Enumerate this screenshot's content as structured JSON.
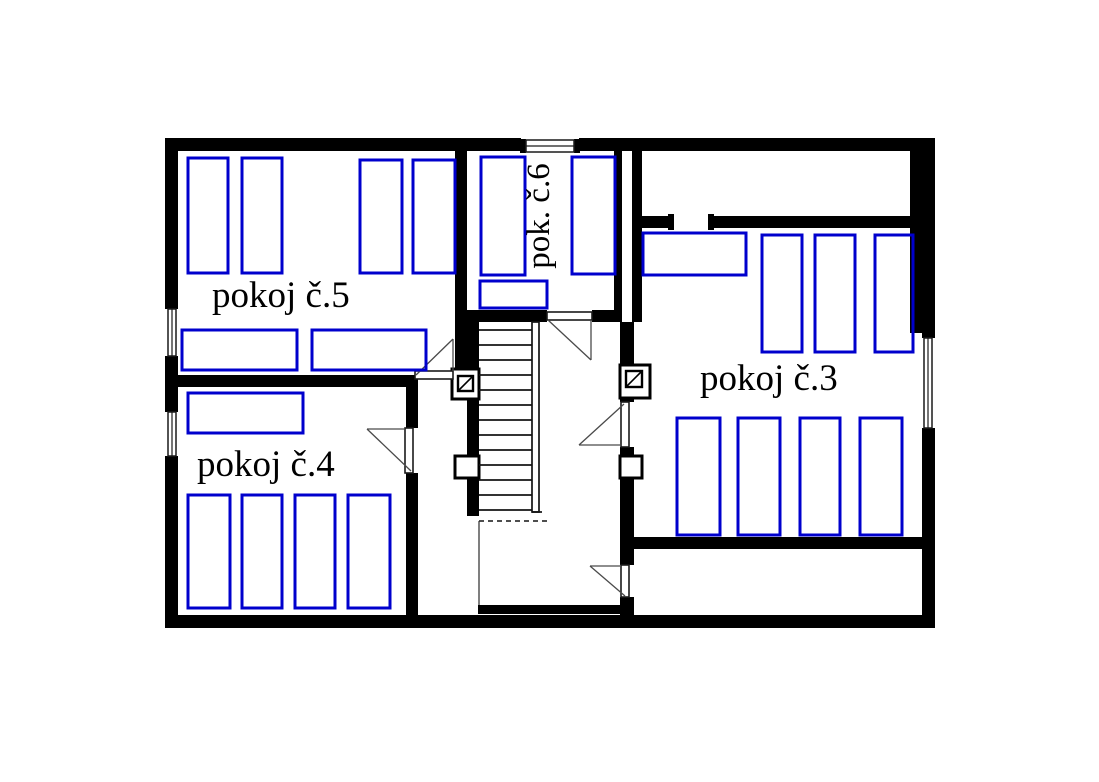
{
  "plan": {
    "type": "floor-plan",
    "rooms": [
      {
        "id": "room5",
        "label": "pokoj č.5",
        "furniture_count": 6
      },
      {
        "id": "room4",
        "label": "pokoj č.4",
        "furniture_count": 5
      },
      {
        "id": "room6",
        "label": "pok. č.6",
        "furniture_count": 3
      },
      {
        "id": "room3",
        "label": "pokoj č.3",
        "furniture_count": 8
      }
    ],
    "features": {
      "staircase_treads": 13,
      "doors": 5,
      "windows": 4,
      "chimney_flues": 2
    },
    "colors": {
      "walls": "#000000",
      "furniture_outline": "#0000cd",
      "background": "#ffffff",
      "thin_lines": "#4a4a4a"
    }
  }
}
